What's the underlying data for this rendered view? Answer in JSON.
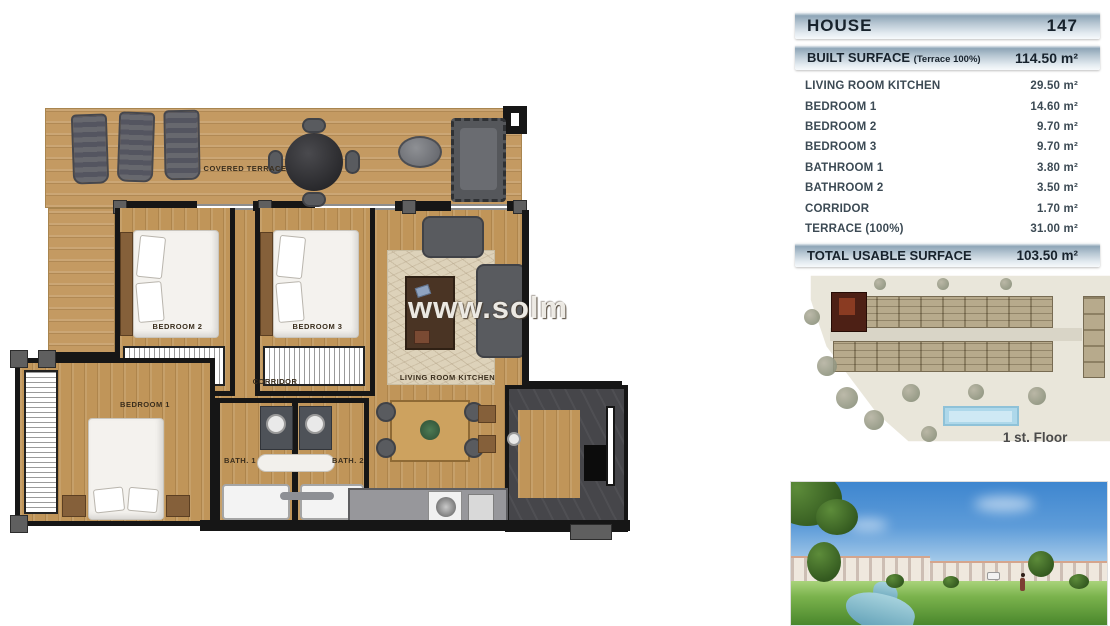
{
  "floor_plan": {
    "watermark_text": "www.solm",
    "labels": {
      "covered_terrace": "COVERED TERRACE",
      "bedroom_1": "BEDROOM 1",
      "bedroom_2": "BEDROOM 2",
      "bedroom_3": "BEDROOM 3",
      "corridor": "CORRIDOR",
      "living_room_kitchen": "LIVING ROOM KITCHEN",
      "bath_1": "BATH. 1",
      "bath_2": "BATH. 2"
    }
  },
  "info_panel": {
    "house": {
      "label": "HOUSE",
      "number": "147"
    },
    "built_surface": {
      "label": "BUILT SURFACE",
      "note": "(Terrace 100%)",
      "value": "114.50 m²"
    },
    "surface_rows": [
      {
        "label": "LIVING ROOM KITCHEN",
        "value": "29.50 m²"
      },
      {
        "label": "BEDROOM 1",
        "value": "14.60 m²"
      },
      {
        "label": "BEDROOM 2",
        "value": "9.70 m²"
      },
      {
        "label": "BEDROOM 3",
        "value": "9.70 m²"
      },
      {
        "label": "BATHROOM 1",
        "value": "3.80 m²"
      },
      {
        "label": "BATHROOM 2",
        "value": "3.50 m²"
      },
      {
        "label": "CORRIDOR",
        "value": "1.70 m²"
      },
      {
        "label": "TERRACE (100%)",
        "value": "31.00 m²"
      }
    ],
    "total": {
      "label": "TOTAL USABLE SURFACE",
      "value": "103.50 m²"
    },
    "site_plan": {
      "floor_label": "1 st. Floor"
    }
  },
  "colors": {
    "bar_gradient_dark": "#8ea5b7",
    "bar_gradient_light": "#f7fafc",
    "bar_text": "#17222c",
    "row_text": "#3c4a54",
    "wood": "#c49a62",
    "wall": "#161616",
    "highlighted_unit": "#4d2015",
    "pool": "#aed8ea",
    "sky": "#3e86cf",
    "grass": "#4a872c"
  }
}
